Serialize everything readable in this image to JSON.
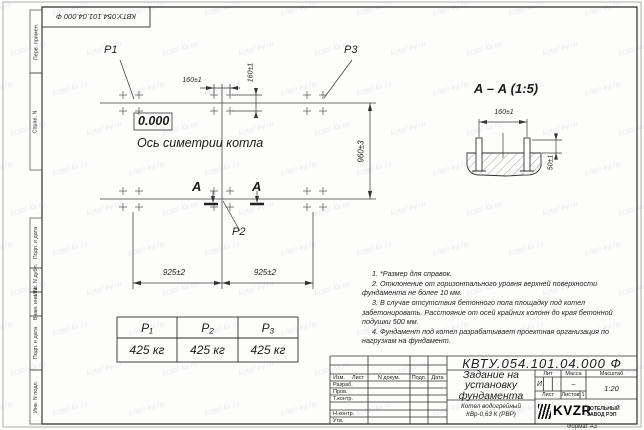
{
  "watermark": {
    "text": "kotel-kv.ru"
  },
  "frame": {
    "stamp_top": "КВТУ.054.101.04.000 Ф",
    "side_labels": [
      "Перв. примен.",
      "Справ. N",
      "Подп. и дата",
      "Инв. N дубл.",
      "Взам. инв. N",
      "Подп. и дата",
      "Инв. N подл."
    ]
  },
  "drawing": {
    "loads": {
      "p1": "P1",
      "p2": "P2",
      "p3": "P3"
    },
    "elevation": "0.000",
    "axis_label": "Ось симетрии котла",
    "section_mark": "А",
    "dims": {
      "h160": "160±1",
      "v160": "160±1",
      "v960": "960±3",
      "w925_left": "925±2",
      "w925_right": "925±2"
    },
    "section_view": {
      "title": "А – А (1:5)",
      "dim_width": "160±1",
      "dim_height": "50±1"
    }
  },
  "loads_table": {
    "headers": [
      "P₁",
      "P₂",
      "P₃"
    ],
    "values": [
      "425 кг",
      "425 кг",
      "425 кг"
    ]
  },
  "notes": [
    "1. *Размер для справок.",
    "2. Отклонение от горизонтального уровня верхней поверхности фундамента не более 10 мм.",
    "3. В случае отсутствия бетонного пола площадку под котел забетонировать. Расстояние от осей крайних колонн до края бетонной подушки 500 мм.",
    "4. Фундамент под котел разрабатывает проектная организация по нагрузкам на фундамент."
  ],
  "title_block": {
    "designation": "КВТУ.054.101.04.000 Ф",
    "doc_title": "Задание на установку фундамента",
    "product_line1": "Котел водогрейный",
    "product_line2": "КВр-0,63 К (РВР)",
    "columns": {
      "izm": "Изм.",
      "list": "Лист",
      "doc": "N докум.",
      "podp": "Подп.",
      "data": "Дата"
    },
    "rows": [
      "Разраб.",
      "Пров.",
      "Т.контр.",
      "Н.контр.",
      "Утв."
    ],
    "lit_label": "Лит",
    "mass_label": "Масса",
    "scale_label": "Масштаб",
    "lit": "И",
    "mass": "–",
    "scale": "1:20",
    "sheet_label": "Лист",
    "sheets_label": "Листов",
    "sheets": "1",
    "logo": "KVZR",
    "logo_sub1": "КОТЕЛЬНЫЙ",
    "logo_sub2": "ЗАВОД РЭП",
    "format": "Формат А3"
  }
}
